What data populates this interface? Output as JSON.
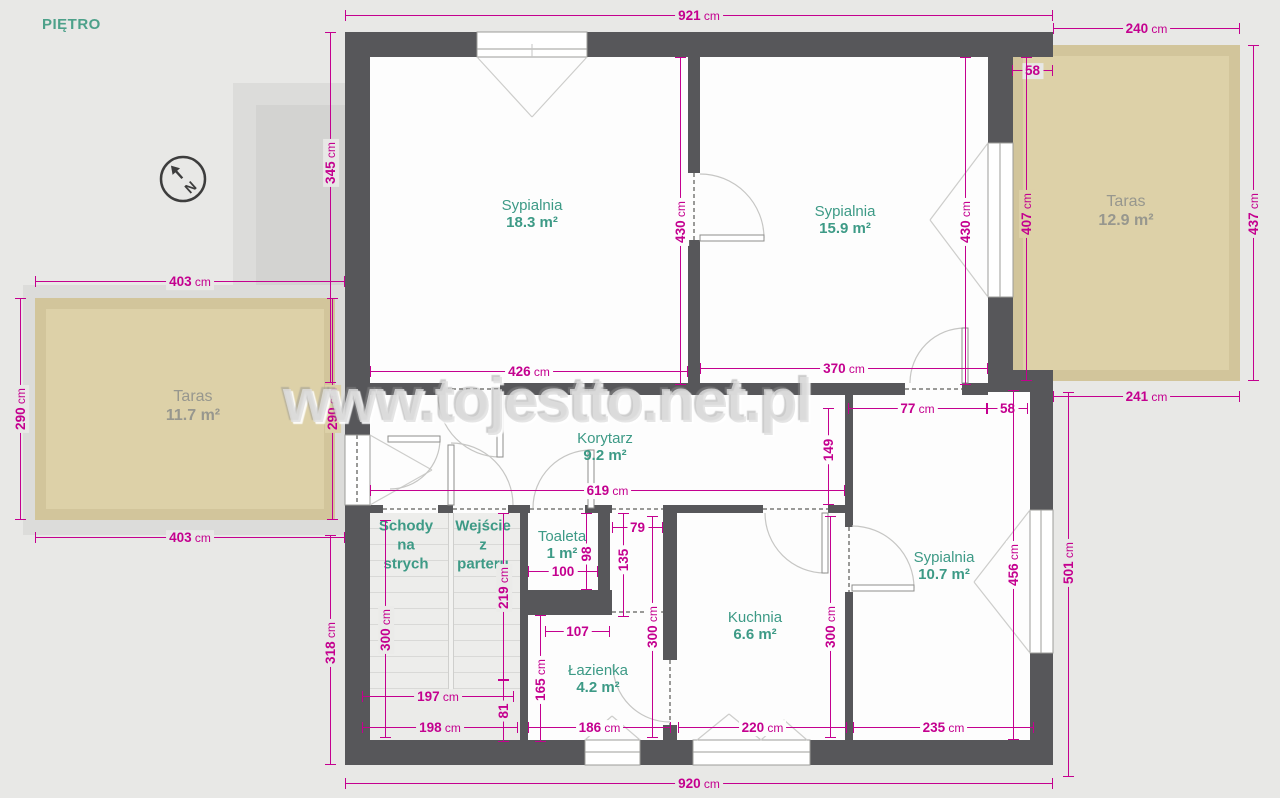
{
  "title": "PIĘTRO",
  "watermark": "www.tojestto.net.pl",
  "compass_label": "N",
  "colors": {
    "dimension": "#c4008f",
    "room_label": "#3d9a86",
    "taras_label": "#97978e",
    "wall": "#57575a",
    "taras_fill": "#ddd1a8",
    "taras_border": "#d2c59b",
    "background": "#e8e8e6"
  },
  "room_labels": [
    {
      "id": "sypialnia-1",
      "name": "Sypialnia",
      "area": "18.3 m²",
      "x": 532,
      "y": 214,
      "type": "room"
    },
    {
      "id": "sypialnia-2",
      "name": "Sypialnia",
      "area": "15.9 m²",
      "x": 845,
      "y": 220,
      "type": "room"
    },
    {
      "id": "taras-right",
      "name": "Taras",
      "area": "12.9 m²",
      "x": 1126,
      "y": 211,
      "type": "taras"
    },
    {
      "id": "taras-left",
      "name": "Taras",
      "area": "11.7 m²",
      "x": 193,
      "y": 406,
      "type": "taras"
    },
    {
      "id": "korytarz",
      "name": "Korytarz",
      "area": "9.2 m²",
      "x": 605,
      "y": 447,
      "type": "room"
    },
    {
      "id": "toaleta",
      "name": "Toaleta",
      "area": "1 m²",
      "x": 562,
      "y": 545,
      "type": "room"
    },
    {
      "id": "lazienka",
      "name": "Łazienka",
      "area": "4.2 m²",
      "x": 598,
      "y": 679,
      "type": "room"
    },
    {
      "id": "kuchnia",
      "name": "Kuchnia",
      "area": "6.6 m²",
      "x": 755,
      "y": 626,
      "type": "room"
    },
    {
      "id": "sypialnia-3",
      "name": "Sypialnia",
      "area": "10.7 m²",
      "x": 944,
      "y": 566,
      "type": "room"
    }
  ],
  "zone_labels": [
    {
      "id": "schody-na-strych",
      "text": "Schody\nna\nstrych",
      "x": 406,
      "y": 545
    },
    {
      "id": "wejscie-z-parteru",
      "text": "Wejście\nz\nparteru",
      "x": 483,
      "y": 545
    }
  ],
  "dimensions": [
    {
      "v": "921",
      "u": "cm",
      "o": "h",
      "x": 345,
      "y": 15,
      "len": 708,
      "bg": "g"
    },
    {
      "v": "240",
      "u": "cm",
      "o": "h",
      "x": 1053,
      "y": 28,
      "len": 187,
      "bg": "g"
    },
    {
      "v": "58",
      "u": "",
      "o": "h",
      "x": 1012,
      "y": 70,
      "len": 41,
      "bg": "g"
    },
    {
      "v": "345",
      "u": "cm",
      "o": "v",
      "x": 330,
      "y": 32,
      "len": 351,
      "bg": "g",
      "ly": 163
    },
    {
      "v": "430",
      "u": "cm",
      "o": "v",
      "x": 680,
      "y": 57,
      "len": 328,
      "bg": "w",
      "ly": 222
    },
    {
      "v": "430",
      "u": "cm",
      "o": "v",
      "x": 965,
      "y": 57,
      "len": 328,
      "bg": "w",
      "ly": 222
    },
    {
      "v": "407",
      "u": "cm",
      "o": "v",
      "x": 1026,
      "y": 57,
      "len": 324,
      "bg": "t",
      "ly": 214
    },
    {
      "v": "437",
      "u": "cm",
      "o": "v",
      "x": 1253,
      "y": 45,
      "len": 336,
      "bg": "g",
      "ly": 214
    },
    {
      "v": "403",
      "u": "cm",
      "o": "h",
      "x": 35,
      "y": 281,
      "len": 310,
      "bg": "g"
    },
    {
      "v": "290",
      "u": "cm",
      "o": "v",
      "x": 20,
      "y": 298,
      "len": 222,
      "bg": "g"
    },
    {
      "v": "290",
      "u": "cm",
      "o": "v",
      "x": 332,
      "y": 298,
      "len": 222,
      "bg": "t"
    },
    {
      "v": "403",
      "u": "cm",
      "o": "h",
      "x": 35,
      "y": 537,
      "len": 310,
      "bg": "g"
    },
    {
      "v": "426",
      "u": "cm",
      "o": "h",
      "x": 370,
      "y": 371,
      "len": 318,
      "bg": "w"
    },
    {
      "v": "370",
      "u": "cm",
      "o": "h",
      "x": 700,
      "y": 368,
      "len": 288,
      "bg": "w"
    },
    {
      "v": "77",
      "u": "cm",
      "o": "h",
      "x": 848,
      "y": 408,
      "len": 139,
      "bg": "w"
    },
    {
      "v": "58",
      "u": "",
      "o": "h",
      "x": 987,
      "y": 408,
      "len": 41,
      "bg": "w"
    },
    {
      "v": "241",
      "u": "cm",
      "o": "h",
      "x": 1053,
      "y": 396,
      "len": 187,
      "bg": "g"
    },
    {
      "v": "619",
      "u": "cm",
      "o": "h",
      "x": 370,
      "y": 490,
      "len": 475,
      "bg": "w"
    },
    {
      "v": "149",
      "u": "",
      "o": "v",
      "x": 828,
      "y": 408,
      "len": 97,
      "bg": "w",
      "ly": 450
    },
    {
      "v": "318",
      "u": "cm",
      "o": "v",
      "x": 330,
      "y": 535,
      "len": 230,
      "bg": "g",
      "ly": 643
    },
    {
      "v": "300",
      "u": "cm",
      "o": "v",
      "x": 385,
      "y": 520,
      "len": 218,
      "bg": "s",
      "ly": 630
    },
    {
      "v": "219",
      "u": "cm",
      "o": "v",
      "x": 503,
      "y": 513,
      "len": 167,
      "bg": "s",
      "ly": 588
    },
    {
      "v": "81",
      "u": "",
      "o": "v",
      "x": 503,
      "y": 680,
      "len": 62,
      "bg": "s",
      "ly": 711
    },
    {
      "v": "100",
      "u": "",
      "o": "h",
      "x": 528,
      "y": 571,
      "len": 70,
      "bg": "w"
    },
    {
      "v": "98",
      "u": "",
      "o": "v",
      "x": 586,
      "y": 513,
      "len": 77,
      "bg": "w",
      "ly": 554
    },
    {
      "v": "79",
      "u": "",
      "o": "h",
      "x": 612,
      "y": 527,
      "len": 51,
      "bg": "w"
    },
    {
      "v": "135",
      "u": "",
      "o": "v",
      "x": 623,
      "y": 513,
      "len": 104,
      "bg": "w",
      "ly": 560
    },
    {
      "v": "107",
      "u": "",
      "o": "h",
      "x": 545,
      "y": 631,
      "len": 65,
      "bg": "w"
    },
    {
      "v": "165",
      "u": "cm",
      "o": "v",
      "x": 540,
      "y": 615,
      "len": 127,
      "bg": "w",
      "ly": 680
    },
    {
      "v": "197",
      "u": "cm",
      "o": "h",
      "x": 362,
      "y": 696,
      "len": 152,
      "bg": "s"
    },
    {
      "v": "198",
      "u": "cm",
      "o": "h",
      "x": 362,
      "y": 727,
      "len": 156,
      "bg": "s"
    },
    {
      "v": "186",
      "u": "cm",
      "o": "h",
      "x": 528,
      "y": 727,
      "len": 143,
      "bg": "w"
    },
    {
      "v": "220",
      "u": "cm",
      "o": "h",
      "x": 678,
      "y": 727,
      "len": 169,
      "bg": "w"
    },
    {
      "v": "235",
      "u": "cm",
      "o": "h",
      "x": 853,
      "y": 727,
      "len": 181,
      "bg": "w"
    },
    {
      "v": "300",
      "u": "cm",
      "o": "v",
      "x": 652,
      "y": 516,
      "len": 222,
      "bg": "w",
      "ly": 627
    },
    {
      "v": "300",
      "u": "cm",
      "o": "v",
      "x": 830,
      "y": 516,
      "len": 222,
      "bg": "w",
      "ly": 627
    },
    {
      "v": "456",
      "u": "cm",
      "o": "v",
      "x": 1013,
      "y": 390,
      "len": 350,
      "bg": "w",
      "ly": 565
    },
    {
      "v": "501",
      "u": "cm",
      "o": "v",
      "x": 1068,
      "y": 392,
      "len": 385,
      "bg": "g",
      "ly": 563
    },
    {
      "v": "920",
      "u": "cm",
      "o": "h",
      "x": 345,
      "y": 783,
      "len": 708,
      "bg": "g"
    }
  ]
}
